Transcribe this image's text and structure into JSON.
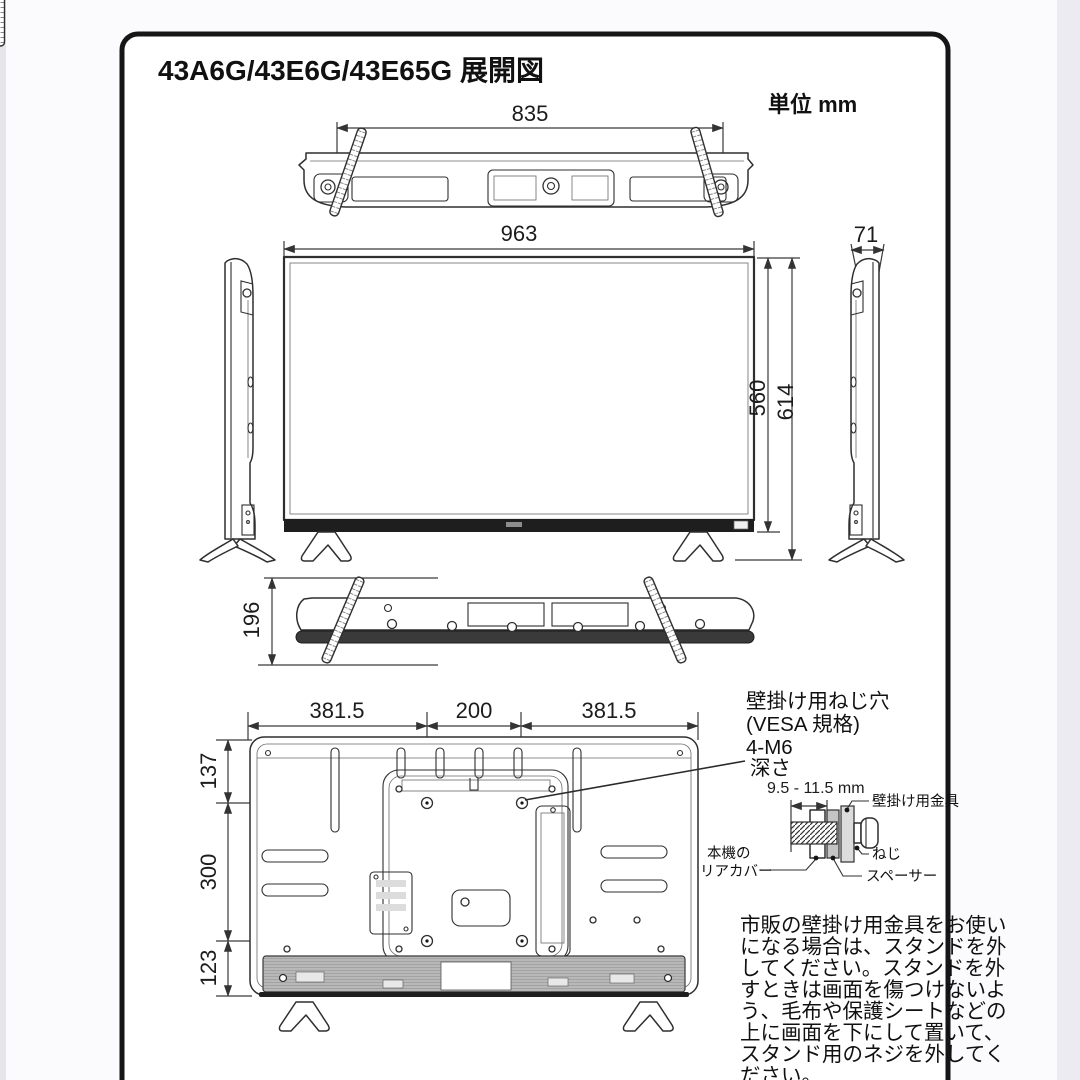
{
  "page": {
    "title": "43A6G/43E6G/43E65G 展開図",
    "unit_label": "単位 mm"
  },
  "dimensions": {
    "top_width": "835",
    "front_width": "963",
    "screen_height": "560",
    "total_height": "614",
    "depth": "71",
    "stand_depth": "196",
    "rear_top_left": "381.5",
    "rear_top_center": "200",
    "rear_top_right": "381.5",
    "rear_side_top": "137",
    "rear_side_middle": "300",
    "rear_side_bottom": "123"
  },
  "vesa_note": {
    "line1": "壁掛け用ねじ穴",
    "line2": "(VESA 規格)",
    "line3": "4-M6",
    "line4": "深さ"
  },
  "bracket_detail": {
    "depth_range": "9.5 - 11.5 mm",
    "bracket_label": "壁掛け用金具",
    "screw_label": "ねじ",
    "spacer_label": "スペーサー",
    "rear_cover_line1": "本機の",
    "rear_cover_line2": "リアカバー"
  },
  "stand_note": {
    "lines": [
      "市販の壁掛け用金具をお使い",
      "になる場合は、スタンドを外",
      "してください。スタンドを外",
      "すときは画面を傷つけないよ",
      "う、毛布や保護シートなどの",
      "上に画面を下にして置いて、",
      "スタンド用のネジを外してく",
      "ださい。"
    ]
  },
  "colors": {
    "line": "#2f2f2f",
    "frame_border": "#161616",
    "bezel": "#1e1e1e",
    "shade": "#b8b8b8"
  }
}
